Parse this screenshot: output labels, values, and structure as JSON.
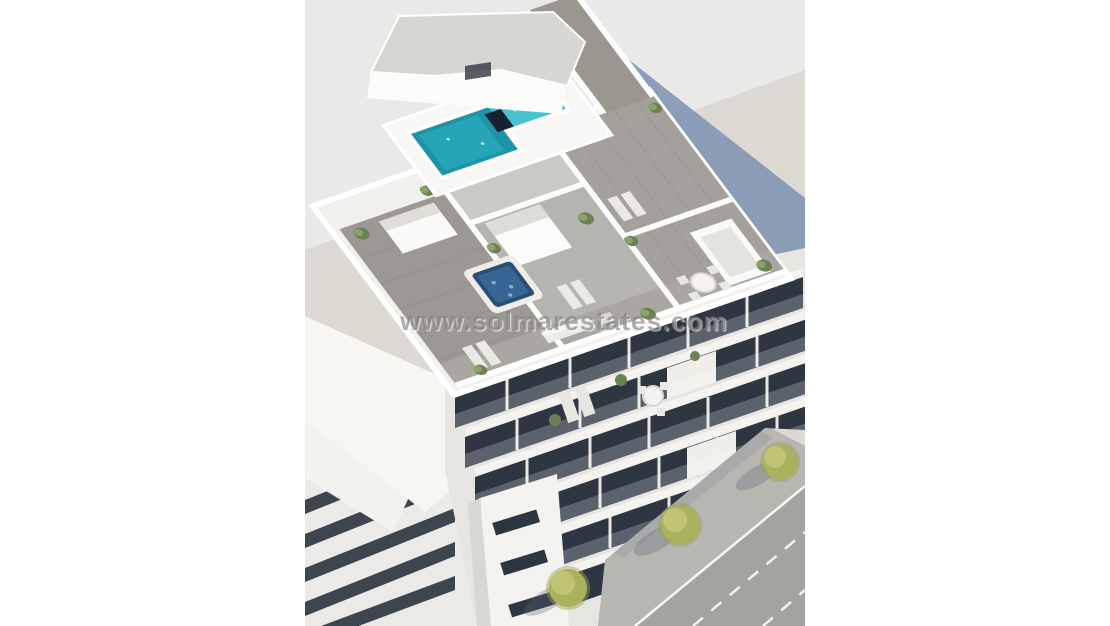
{
  "watermark": {
    "text": "www.solmarestates.com"
  },
  "colors": {
    "canvas": "#ffffff",
    "sky": "#e9e9e7",
    "ground": "#dcd8d2",
    "shadow": "#8093b3",
    "building": "#f7f6f3",
    "glazing": "#2e3642",
    "deck": "#9c9994",
    "pool_dark": "#1f93a8",
    "pool_light": "#47c3d0",
    "hot_tub": "#2a4e74",
    "plant": "#6d8054",
    "tree": "#aab25e",
    "asphalt": "#a5a39f",
    "sidewalk": "#b8b6b1",
    "road_marking": "#ffffff",
    "watermark_gray": "#7d7d7d"
  }
}
